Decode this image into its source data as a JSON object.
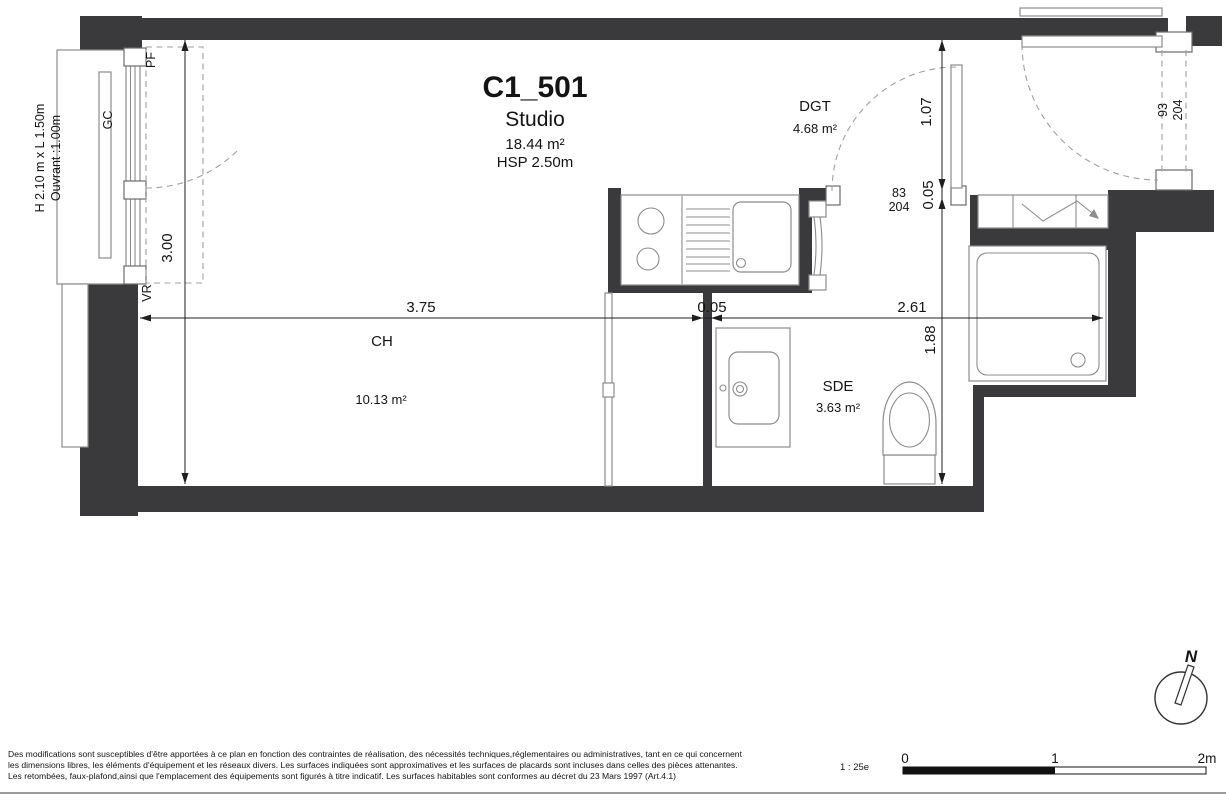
{
  "header": {
    "unit_id": "C1_501",
    "unit_type": "Studio",
    "area": "18.44 m²",
    "ceiling": "HSP 2.50m"
  },
  "rooms": {
    "ch": {
      "code": "CH",
      "area": "10.13 m²"
    },
    "dgt": {
      "code": "DGT",
      "area": "4.68 m²"
    },
    "sde": {
      "code": "SDE",
      "area": "3.63 m²"
    }
  },
  "dims": {
    "ch_w": "3.75",
    "wall_ch_sde": "0.05",
    "sde_w": "2.61",
    "ch_h": "3.00",
    "dgt_d": "1.07",
    "wall_dgt_sde": "0.05",
    "sde_d": "1.88"
  },
  "doors": {
    "sde": {
      "w": "83",
      "h": "204"
    },
    "entry": {
      "w": "93",
      "h": "204"
    }
  },
  "window": {
    "size": "H 2.10 m x L 1.50m",
    "opening": "Ouvrant :1.00m",
    "gc": "GC",
    "pf": "PF",
    "vr": "VR"
  },
  "footer": {
    "disclaimer": [
      "Des modifications sont susceptibles d'être apportées à ce plan en fonction des contraintes de réalisation, des nécessités techniques,réglementaires ou administratives, tant en ce qui concernent",
      "les dimensions libres, les éléments d'équipement et les réseaux divers. Les surfaces indiquées sont approximatives et les surfaces de placards sont incluses dans celles des pièces attenantes.",
      "Les retombées, faux-plafond,ainsi que l'emplacement des équipements sont figurés à titre indicatif. Les surfaces habitables sont conformes au décret du 23 Mars 1997 (Art.4.1)"
    ],
    "scale": "1 : 25e",
    "ticks": [
      "0",
      "1",
      "2m"
    ],
    "north": "N"
  },
  "colors": {
    "wall": "#3a3a3c",
    "dim": "#1f1f1f",
    "fixture": "#8c8c8c",
    "text": "#141414"
  }
}
